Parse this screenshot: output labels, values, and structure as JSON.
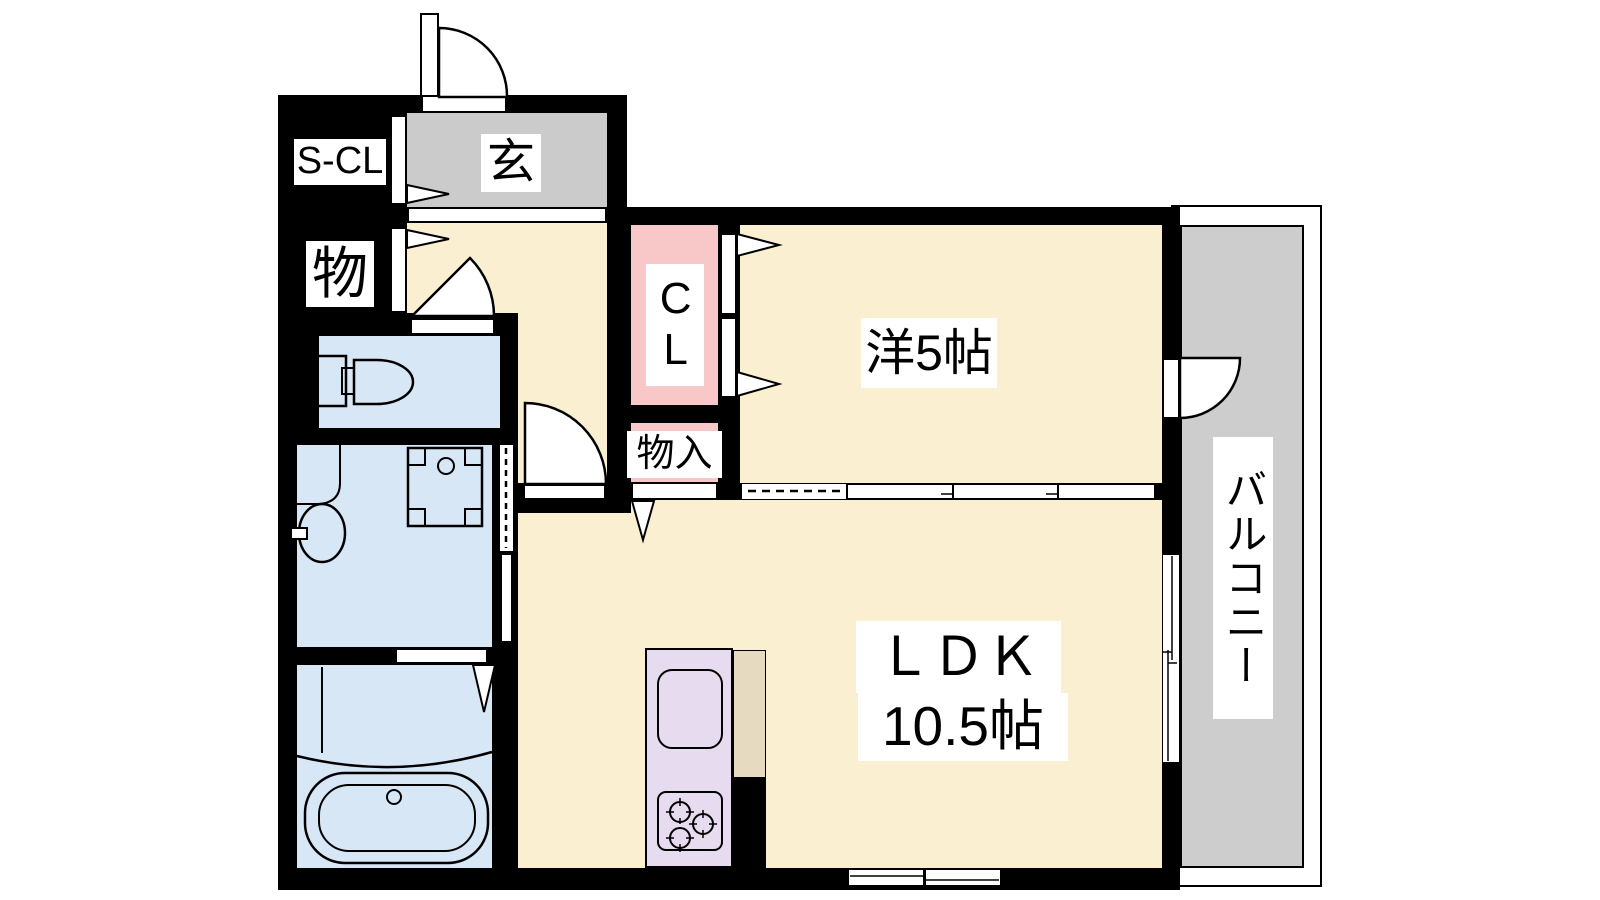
{
  "plan_type": "apartment-floorplan",
  "colors": {
    "wall": "#000000",
    "line": "#000000",
    "room_cream": "#FBEFD2",
    "closet_pink": "#F8C7C7",
    "entry_gray": "#CBCBCB",
    "balcony_gray": "#CDCDCD",
    "wet_blue": "#D8E7F6",
    "kitchen_lavender": "#E7DBF0",
    "counter_tan": "#E6DAC0",
    "label_bg": "#FFFFFF"
  },
  "rooms": {
    "shoe_closet": {
      "label": "S-CL"
    },
    "entrance": {
      "label": "玄"
    },
    "storage": {
      "label": "物"
    },
    "closet": {
      "label": "CL"
    },
    "inner_storage": {
      "label": "物入"
    },
    "western_room": {
      "label": "洋5帖"
    },
    "ldk": {
      "label": "ＬＤＫ",
      "size": "10.5帖"
    },
    "balcony": {
      "label": "バルコニー"
    }
  }
}
